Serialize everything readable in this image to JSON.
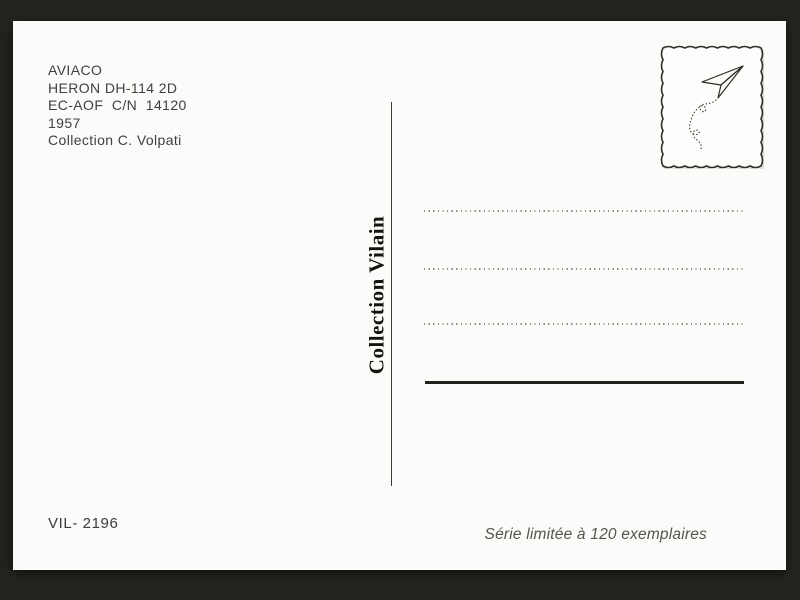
{
  "background_color": "#22241f",
  "card": {
    "color": "#fbfbf9",
    "info_block": {
      "lines": [
        "AVIACO",
        "HERON DH-114 2D",
        "EC-AOF  C/N  14120",
        "1957",
        "Collection C. Volpati"
      ]
    },
    "publisher": {
      "text": "Collection Vilain"
    },
    "stamp": {
      "icon": "paper-plane",
      "trail": "dotted-flight-path"
    },
    "address_area": {
      "dotted_lines": 3,
      "solid_lines": 1
    },
    "footer": {
      "catalog_number": "VIL- 2196",
      "edition_note": "Série limitée à 120 exemplaires"
    }
  },
  "colors": {
    "ink": "#3f3f3d",
    "serif_ink": "#15150f",
    "dotted_line": "#8e8e89",
    "solid_line": "#21211d",
    "muted_ink": "#55544f",
    "stamp_border": "#2e2e2a"
  }
}
